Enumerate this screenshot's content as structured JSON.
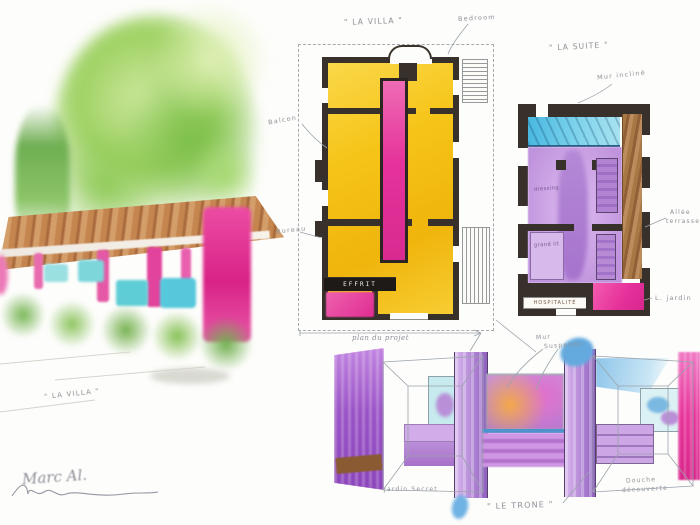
{
  "colors": {
    "paper": "#fdfdfb",
    "wall_ink": "#38302a",
    "room_yellow": "#f6c417",
    "accent_pink": "#e43a98",
    "pool_blue": "#5ec5e6",
    "suite_purple": "#c9a0e2",
    "wood_brown": "#9c6a40",
    "roof_brown": "#bc7a4c",
    "annotation_gray": "#8e8e97"
  },
  "exterior": {
    "caption": "\" LA VILLA \"",
    "signature": "Marc Al."
  },
  "villa_plan": {
    "title": "\" LA VILLA \"",
    "label_bedroom": "Bedroom",
    "label_balcony": "Balcon",
    "label_bureau": "Bureau",
    "black_bar_text": "EFFRIT",
    "caption": "plan du projet"
  },
  "suite_plan": {
    "title": "\" LA SUITE \"",
    "label_wall": "Mur incliné",
    "label_terrace_line1": "Allée",
    "label_terrace_line2": "terrasse",
    "label_garden": "L. jardin",
    "label_service": "HOSPITALITÉ",
    "label_closet": "dressing",
    "label_bed": "grand lit"
  },
  "interior": {
    "title": "\" LE TRONE \"",
    "label_wall_line1": "Mur",
    "label_wall_line2": "Suspendu",
    "label_left": "Jardin Secret",
    "label_right_line1": "Douche",
    "label_right_line2": "découverte"
  }
}
